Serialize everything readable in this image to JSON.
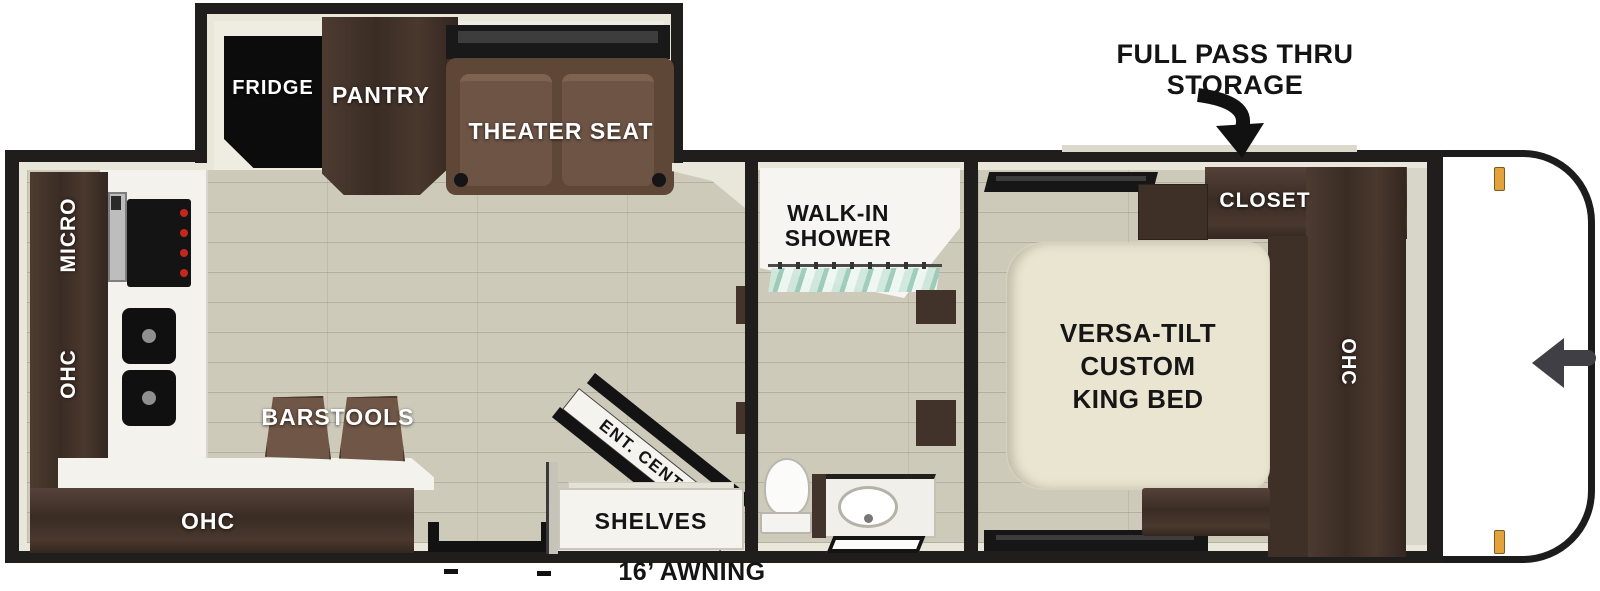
{
  "diagram": {
    "type": "RV travel trailer floorplan",
    "annotations": {
      "storage_line1": "FULL PASS THRU",
      "storage_line2": "STORAGE",
      "awning": "16’ AWNING"
    },
    "slide_out": {
      "fridge": "FRIDGE",
      "pantry": "PANTRY",
      "theater_seat": "THEATER SEAT"
    },
    "kitchen": {
      "micro": "MICRO",
      "ohc_wall": "OHC",
      "ohc_counter": "OHC",
      "barstools": "BARSTOOLS"
    },
    "living": {
      "ent_center": "ENT. CENTER",
      "shelves": "SHELVES"
    },
    "bathroom": {
      "shower_line1": "WALK-IN",
      "shower_line2": "SHOWER"
    },
    "bedroom": {
      "closet": "CLOSET",
      "bed_line1": "VERSA-TILT",
      "bed_line2": "CUSTOM",
      "bed_line3": "KING BED",
      "ohc": "OHC"
    }
  },
  "colors": {
    "wall_black": "#201e1c",
    "lining_cream": "#e9e6da",
    "floor_plank": "#cdcaba",
    "cabinet_wood": "#46362c",
    "seat_brown": "#6d5445",
    "bed_cream": "#e9e5d1",
    "counter_white": "#f3f2ec",
    "shower_glass_teal": "#9ccbb9",
    "burner_red": "#c3271d",
    "marker_amber": "#e3a23c"
  }
}
